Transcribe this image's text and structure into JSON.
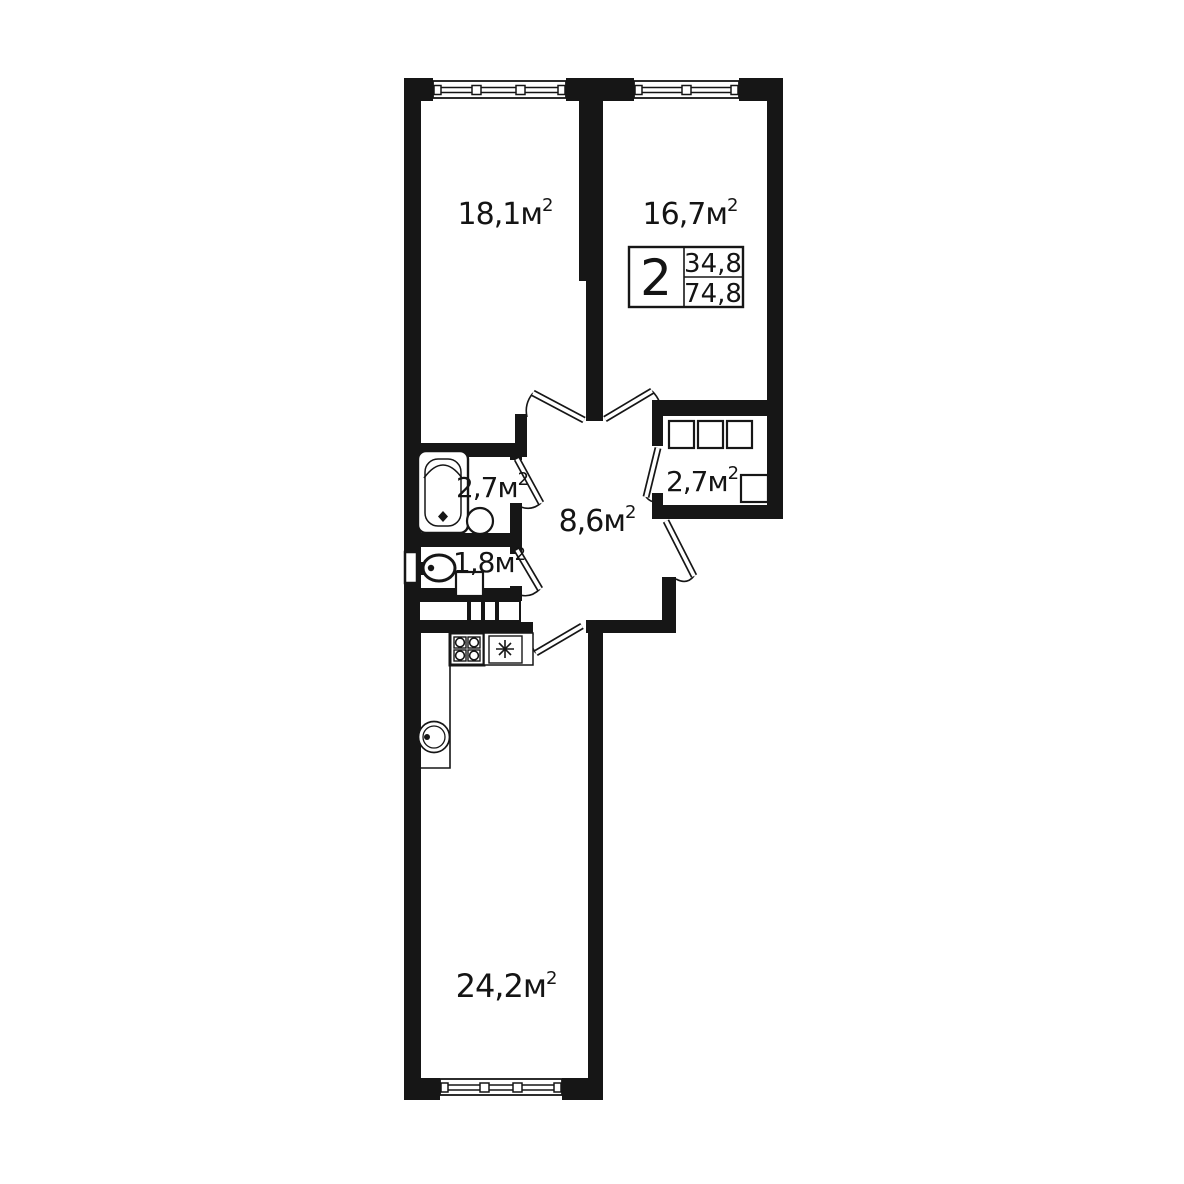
{
  "plan": {
    "unit": "м",
    "unit_exp": "2",
    "rooms": [
      {
        "name": "bedroom-1",
        "area": "18,1"
      },
      {
        "name": "bedroom-2",
        "area": "16,7"
      },
      {
        "name": "bathroom",
        "area": "2,7"
      },
      {
        "name": "wardrobe",
        "area": "2,7"
      },
      {
        "name": "hallway",
        "area": "8,6"
      },
      {
        "name": "wc",
        "area": "1,8"
      },
      {
        "name": "kitchen-living-room",
        "area": "24,2"
      }
    ],
    "info_badge": {
      "rooms_count": "2",
      "upper_value": "34,8",
      "lower_value": "74,8"
    },
    "colors": {
      "walls": "#161616",
      "background": "#ffffff"
    }
  }
}
